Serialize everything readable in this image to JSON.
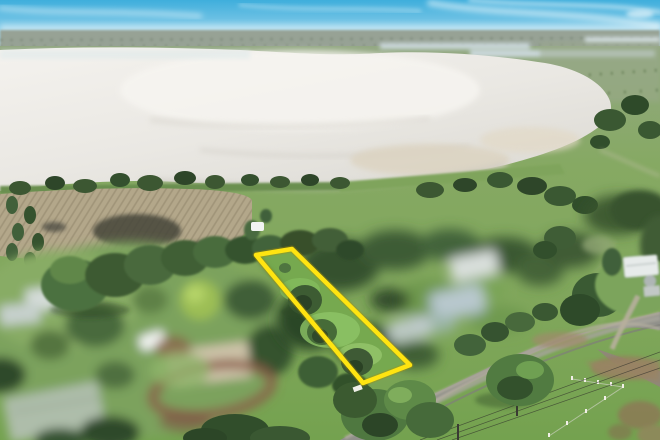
{
  "meta": {
    "type": "aerial-photograph",
    "subject": "drone photo of a rural lakeside lot for sale, highlighted with a yellow boundary, large white salt lake behind, neighbouring properties blurred for privacy",
    "width": 660,
    "height": 440
  },
  "overlay": {
    "lot_boundary": {
      "points": "256,255 292,249 410,365 363,383",
      "stroke": "#FFE411",
      "stroke_width": "4.5",
      "glow": "#B08E00"
    },
    "survey_marker_color": "#EFEFE8"
  },
  "palette": {
    "sky_top": "#3FAEDC",
    "sky_low": "#C4E5F1",
    "horizon_land": "#97A295",
    "distant_water": "#CBD8DB",
    "lake_bright": "#F4F2EE",
    "lake_dim": "#DCDAD4",
    "lake_shallow": "#DCD3C0",
    "farmland": "#B3A78A",
    "burnt_soil": "#45443A",
    "pasture": "#85AB62",
    "lawn": "#7CA25D",
    "tree_dark": "#31502C",
    "tree_mid": "#4E7540",
    "tree_bright": "#9CBE55",
    "road": "#90908A",
    "road_shoulder": "#B3AE9F",
    "dirt_track": "#8A5A48",
    "shed_tan": "#CDC3A9",
    "shed_sage": "#AEBDAA",
    "greenhouse": "#AEC0C6",
    "white_structure": "#E7EBEA",
    "gravel": "#97805F",
    "fence_post": "#F2F0E8",
    "vehicle_white": "#F2F4F2"
  },
  "blurred_privacy_regions": [
    "left-neighbor-property",
    "right-neighbor-property"
  ]
}
